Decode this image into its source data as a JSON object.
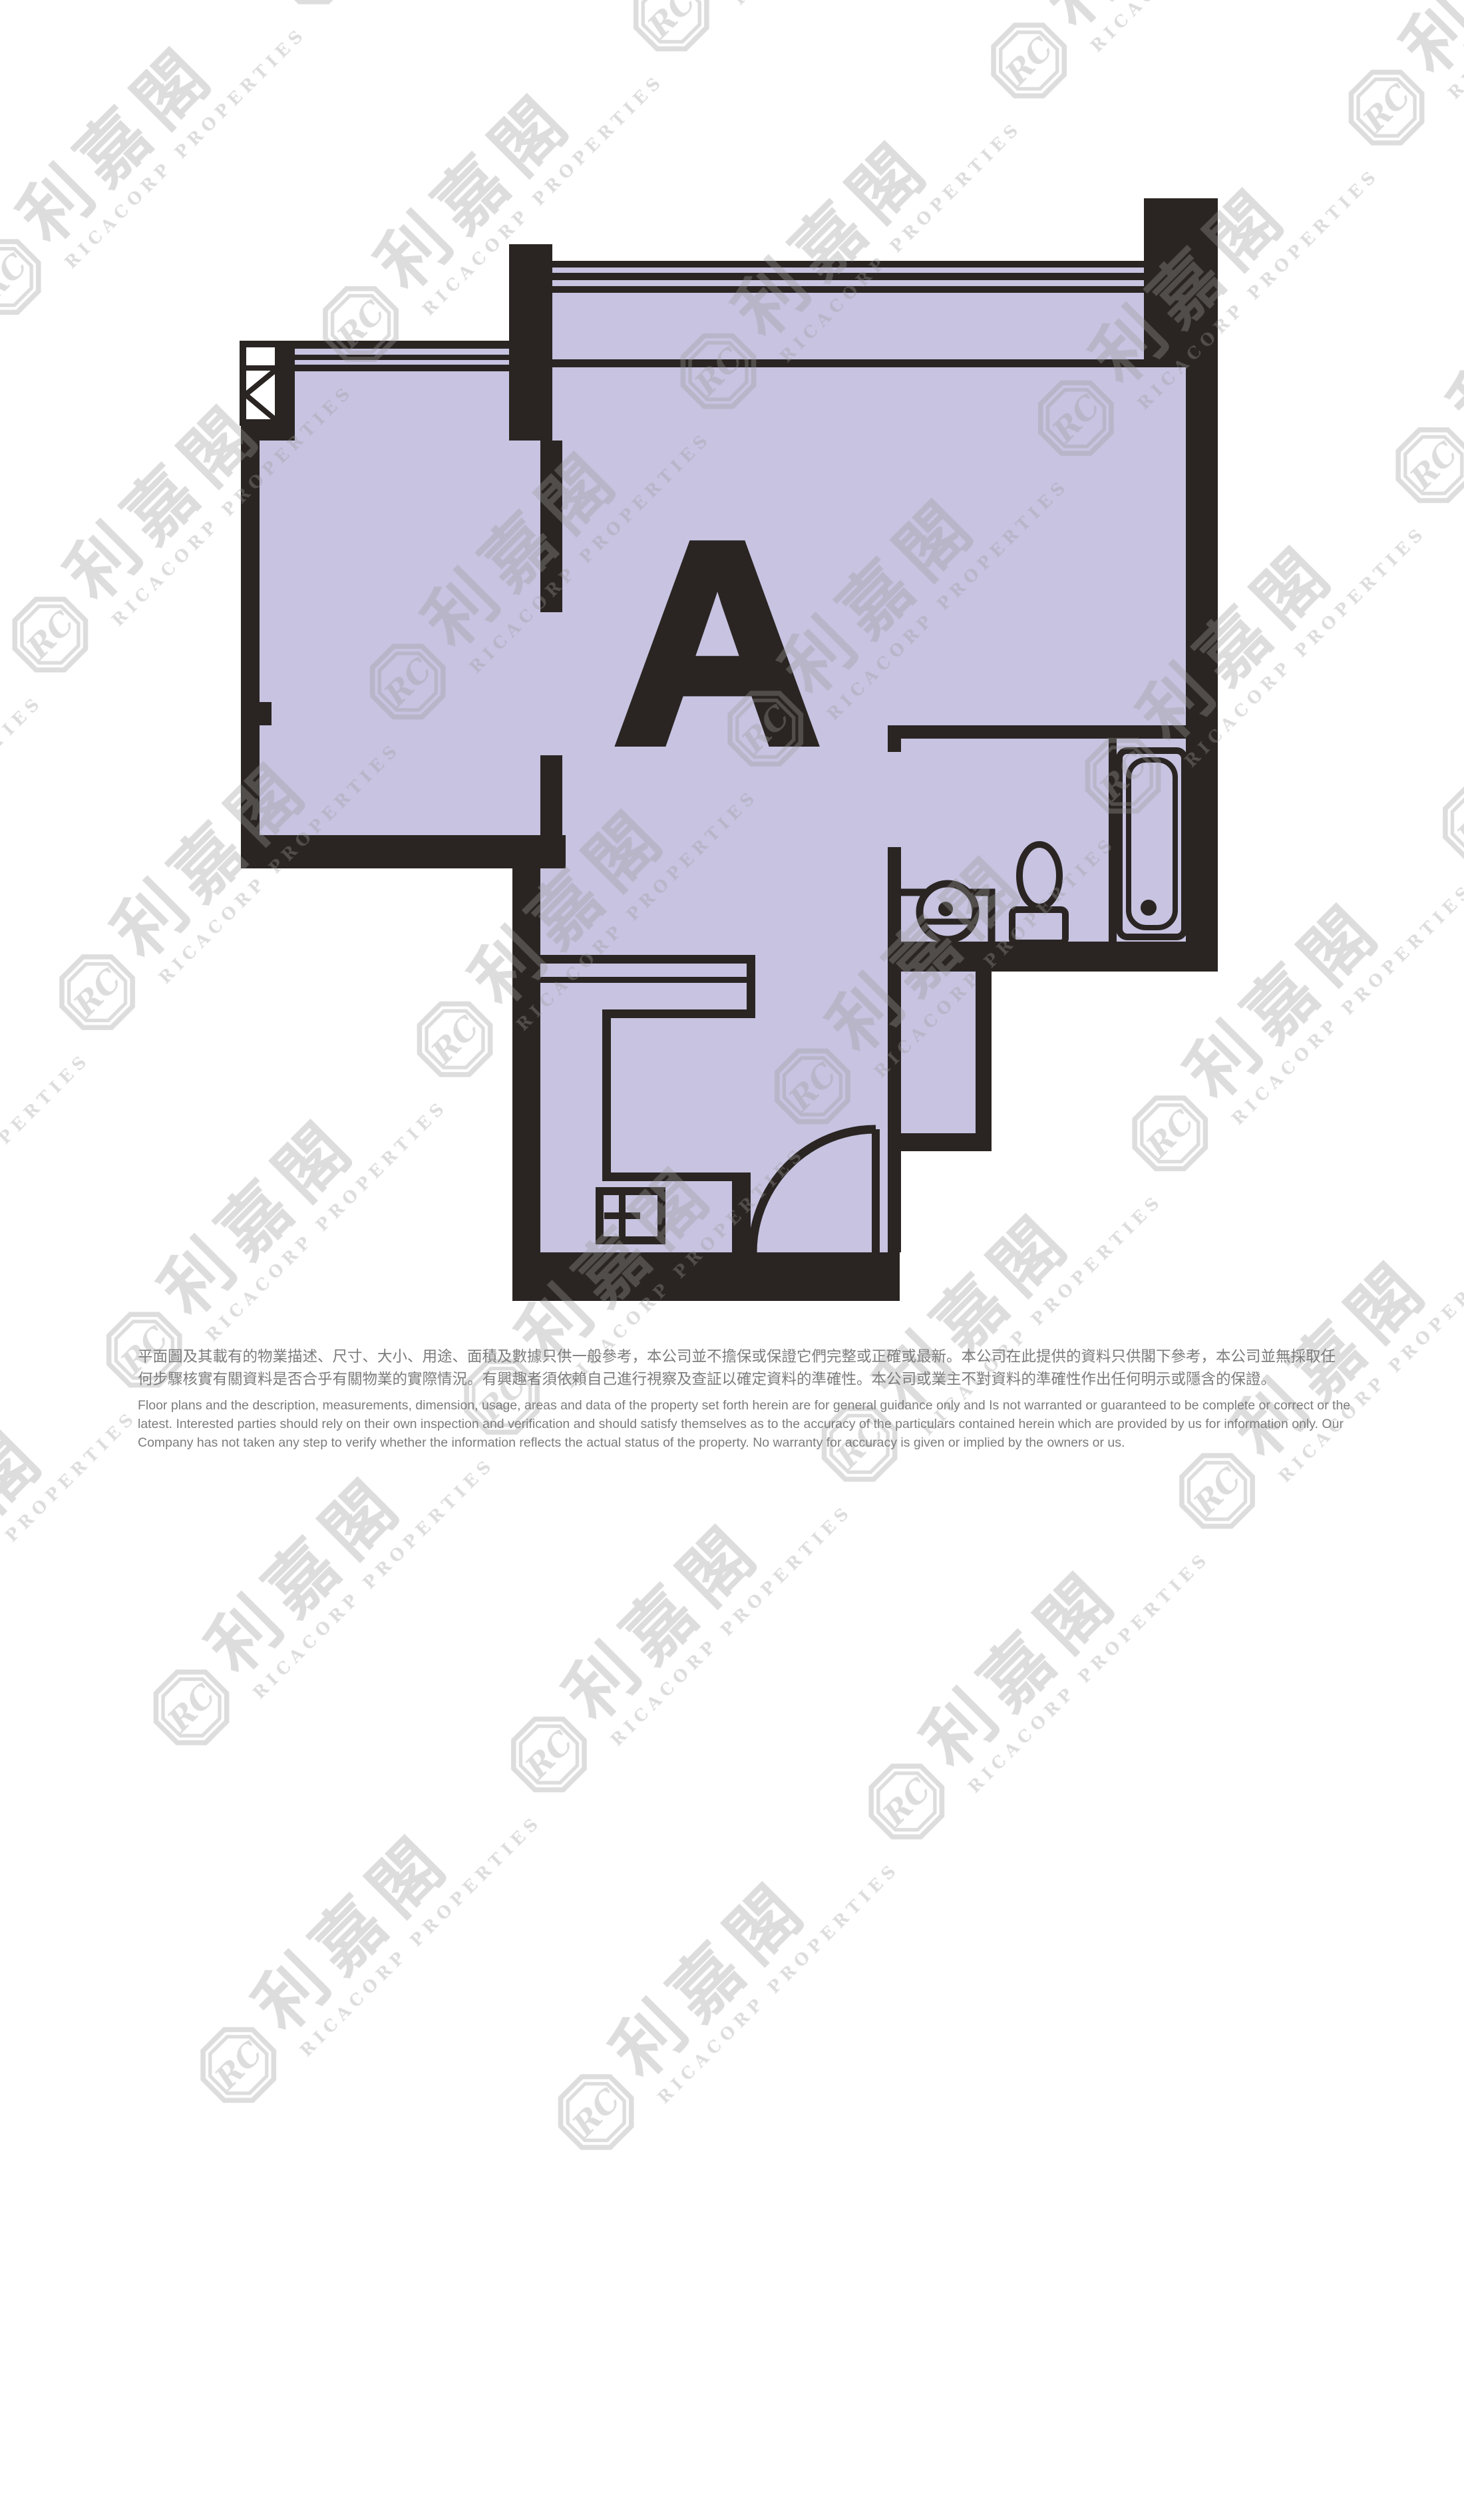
{
  "page": {
    "background_color": "#ffffff"
  },
  "floor_plan": {
    "unit_label": "A",
    "colors": {
      "wall": "#2a2522",
      "floor": "#c7c3e1"
    }
  },
  "watermark": {
    "logo_text": "RC",
    "brand_zh": "利嘉閣",
    "brand_en": "RICACORP PROPERTIES",
    "color": "#9a9a9a"
  },
  "disclaimer": {
    "color": "#7c7c7c",
    "zh_line1": "平面圖及其載有的物業描述、尺寸、大小、用途、面積及數據只供一般參考，本公司並不擔保或保證它們完整或正確或最新。本公司在此提供的資料只供閣下參考，本公司並無採取任",
    "zh_line2": "何步驟核實有關資料是否合乎有關物業的實際情況。有興趣者須依賴自己進行視察及查証以確定資料的準確性。本公司或業主不對資料的準確性作出任何明示或隱含的保證。",
    "en_line1": "Floor plans and the description, measurements, dimension, usage, areas and data of the property set forth herein are for general guidance only and Is not warranted or guaranteed to be complete or correct or the",
    "en_line2": "latest. Interested parties should rely on their own inspection and verification and should satisfy themselves as to the accuracy of the particulars contained herein which are provided by us for information only.  Our",
    "en_line3": "Company has not taken any step to verify whether the information reflects the actual status of the property.  No warranty for accuracy is given or implied by the owners or us."
  }
}
